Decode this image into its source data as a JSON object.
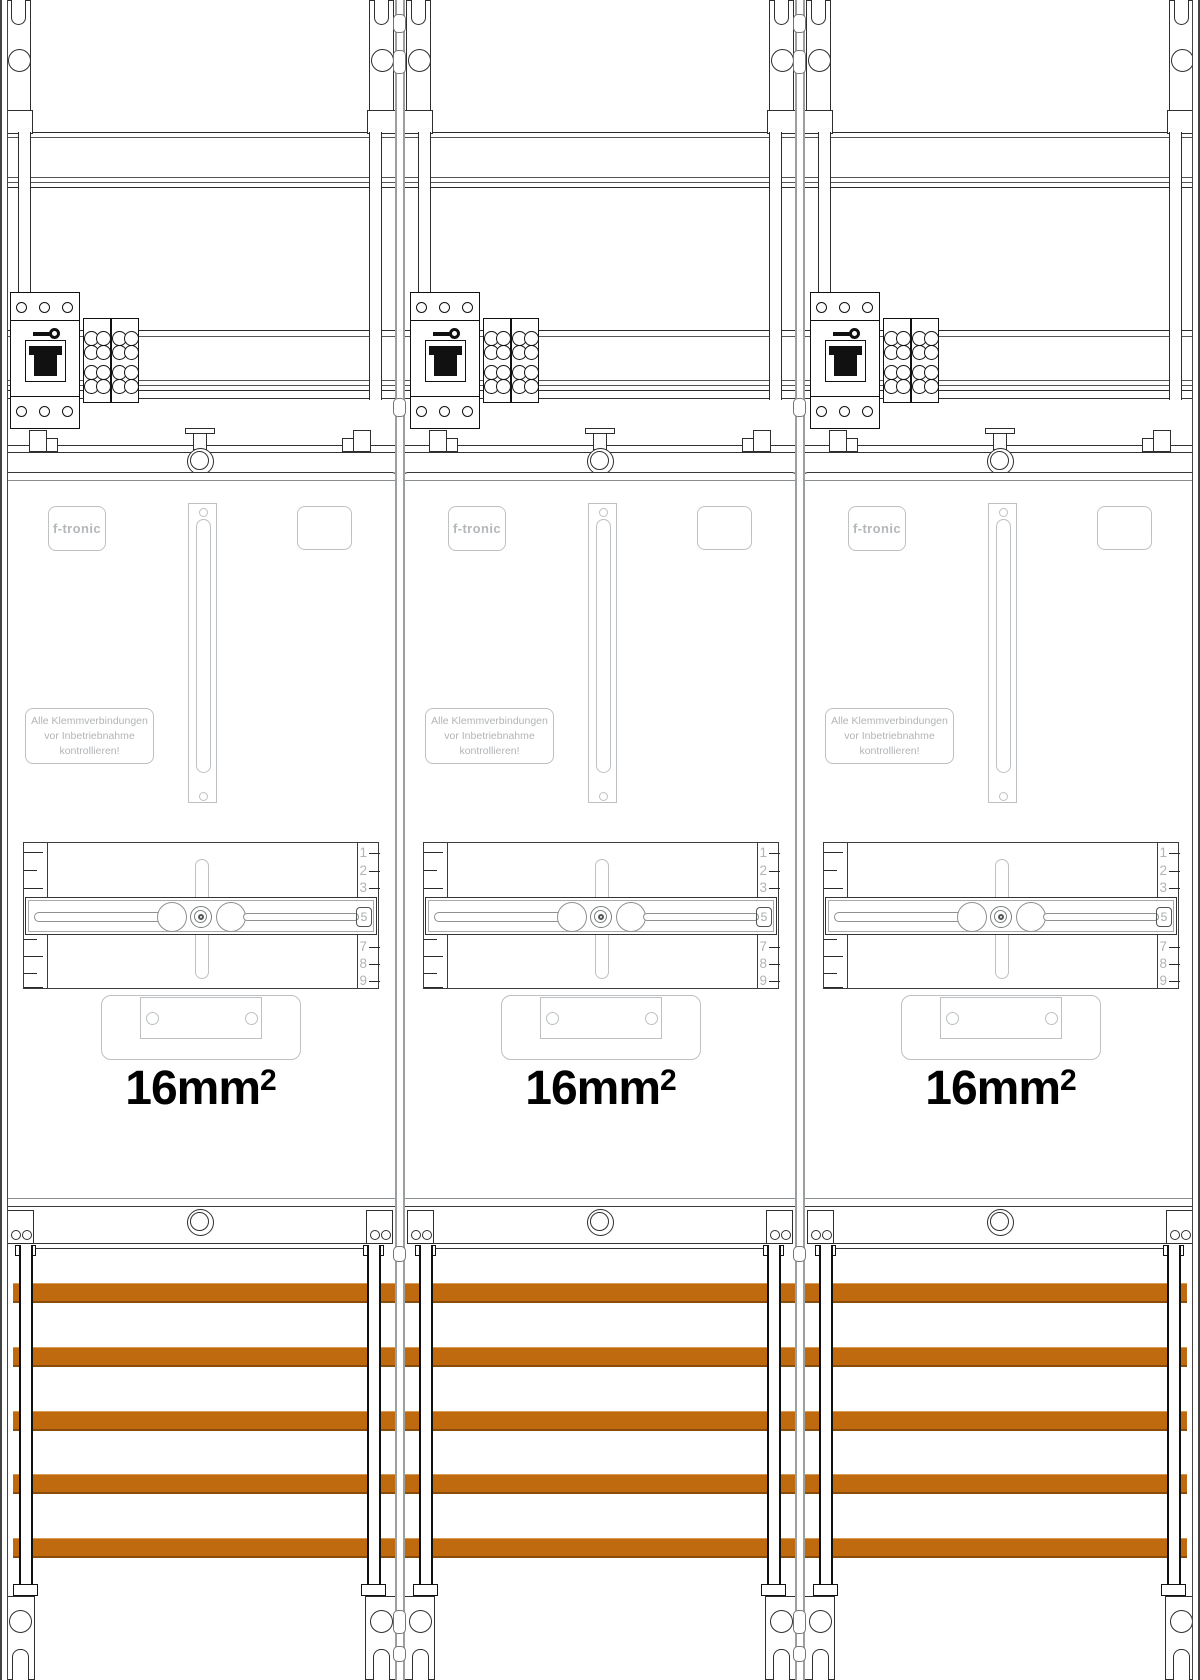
{
  "busbars": {
    "count": 5,
    "color": "#c06a10"
  },
  "modules": [
    {
      "brand": "f-tronic",
      "warning_lines": [
        "Alle Klemmverbindungen",
        "vor Inbetriebnahme",
        "kontrollieren!"
      ],
      "cross_section_label": "16mm",
      "cross_section_exponent": "2",
      "scale_numbers_top": [
        "1",
        "2",
        "3"
      ],
      "scale_numbers_bottom": [
        "7",
        "8",
        "9"
      ],
      "scale_indicator": "5"
    },
    {
      "brand": "f-tronic",
      "warning_lines": [
        "Alle Klemmverbindungen",
        "vor Inbetriebnahme",
        "kontrollieren!"
      ],
      "cross_section_label": "16mm",
      "cross_section_exponent": "2",
      "scale_numbers_top": [
        "1",
        "2",
        "3"
      ],
      "scale_numbers_bottom": [
        "7",
        "8",
        "9"
      ],
      "scale_indicator": "5"
    },
    {
      "brand": "f-tronic",
      "warning_lines": [
        "Alle Klemmverbindungen",
        "vor Inbetriebnahme",
        "kontrollieren!"
      ],
      "cross_section_label": "16mm",
      "cross_section_exponent": "2",
      "scale_numbers_top": [
        "1",
        "2",
        "3"
      ],
      "scale_numbers_bottom": [
        "7",
        "8",
        "9"
      ],
      "scale_indicator": "5"
    }
  ]
}
